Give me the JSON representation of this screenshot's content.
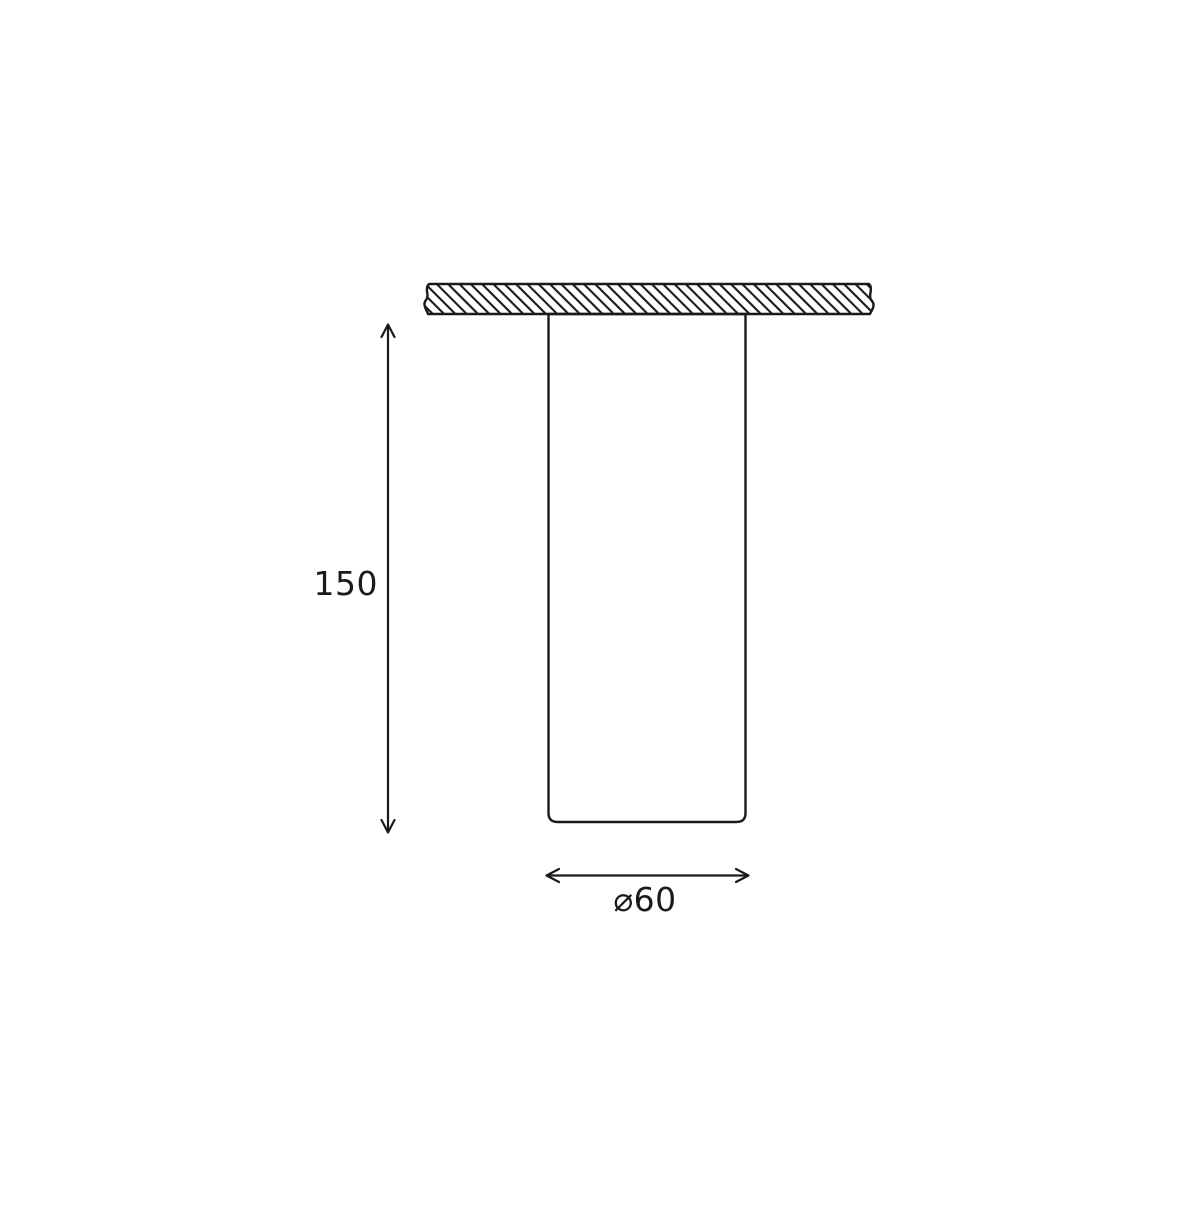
{
  "diagram": {
    "type": "technical-dimension-drawing",
    "background_color": "#ffffff",
    "line_color": "#1a1a1a",
    "dimensions": {
      "height_label": "150",
      "diameter_label": "⌀60"
    }
  }
}
